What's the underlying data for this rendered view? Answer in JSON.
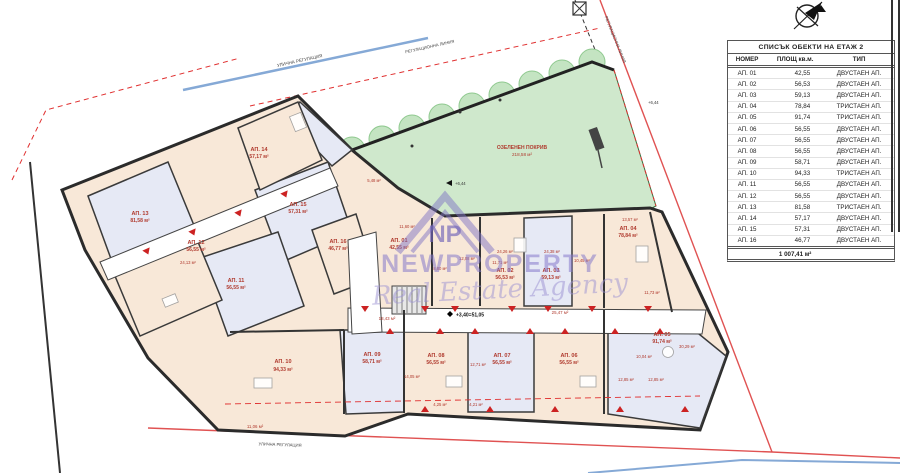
{
  "table": {
    "title": "СПИСЪК ОБЕКТИ НА ЕТАЖ 2",
    "col_number": "НОМЕР",
    "col_area": "ПЛОЩ кв.м.",
    "col_type": "ТИП",
    "total": "1 007,41 м²"
  },
  "apartments": [
    {
      "num": "АП. 01",
      "area": "42,55",
      "type": "ДВУСТАЕН АП."
    },
    {
      "num": "АП. 02",
      "area": "56,53",
      "type": "ДВУСТАЕН АП."
    },
    {
      "num": "АП. 03",
      "area": "59,13",
      "type": "ДВУСТАЕН АП."
    },
    {
      "num": "АП. 04",
      "area": "78,84",
      "type": "ТРИСТАЕН АП."
    },
    {
      "num": "АП. 05",
      "area": "91,74",
      "type": "ТРИСТАЕН АП."
    },
    {
      "num": "АП. 06",
      "area": "56,55",
      "type": "ДВУСТАЕН АП."
    },
    {
      "num": "АП. 07",
      "area": "56,55",
      "type": "ДВУСТАЕН АП."
    },
    {
      "num": "АП. 08",
      "area": "56,55",
      "type": "ДВУСТАЕН АП."
    },
    {
      "num": "АП. 09",
      "area": "58,71",
      "type": "ДВУСТАЕН АП."
    },
    {
      "num": "АП. 10",
      "area": "94,33",
      "type": "ТРИСТАЕН АП."
    },
    {
      "num": "АП. 11",
      "area": "56,55",
      "type": "ДВУСТАЕН АП."
    },
    {
      "num": "АП. 12",
      "area": "56,55",
      "type": "ДВУСТАЕН АП."
    },
    {
      "num": "АП. 13",
      "area": "81,58",
      "type": "ТРИСТАЕН АП."
    },
    {
      "num": "АП. 14",
      "area": "57,17",
      "type": "ДВУСТАЕН АП."
    },
    {
      "num": "АП. 15",
      "area": "57,31",
      "type": "ДВУСТАЕН АП."
    },
    {
      "num": "АП. 16",
      "area": "46,77",
      "type": "ДВУСТАЕН АП."
    }
  ],
  "plan": {
    "green_roof_label": "ОЗЕЛЕНЕН ПОКРИВ",
    "green_roof_area": "218,58 м²",
    "level_mark": "+3,40=51,05",
    "roof_mark": "+6,44",
    "corridor_area_1": "18,43 м²",
    "corridor_area_2": "25,47 м²",
    "terrace_area": "11,06 м²",
    "street_label": "УЛИЧНА РЕГУЛАЦИЯ",
    "boundary_label": "РЕГУЛАЦИОННА ЛИНИЯ",
    "units": [
      {
        "num": "АП. 01",
        "area": "42,55 м²"
      },
      {
        "num": "АП. 02",
        "area": "56,53 м²"
      },
      {
        "num": "АП. 03",
        "area": "59,13 м²"
      },
      {
        "num": "АП. 04",
        "area": "78,84 м²"
      },
      {
        "num": "АП. 05",
        "area": "91,74 м²"
      },
      {
        "num": "АП. 06",
        "area": "56,55 м²"
      },
      {
        "num": "АП. 07",
        "area": "56,55 м²"
      },
      {
        "num": "АП. 08",
        "area": "56,55 м²"
      },
      {
        "num": "АП. 09",
        "area": "58,71 м²"
      },
      {
        "num": "АП. 10",
        "area": "94,33 м²"
      },
      {
        "num": "АП. 11",
        "area": "56,55 м²"
      },
      {
        "num": "АП. 12",
        "area": "56,55 м²"
      },
      {
        "num": "АП. 13",
        "area": "81,58 м²"
      },
      {
        "num": "АП. 14",
        "area": "57,17 м²"
      },
      {
        "num": "АП. 15",
        "area": "57,31 м²"
      },
      {
        "num": "АП. 16",
        "area": "46,77 м²"
      }
    ],
    "room_labels": [
      "5,48 м²",
      "11,60 м²",
      "12,08 м²",
      "8,80 м²",
      "11,71 м²",
      "24,26 м²",
      "24,38 м²",
      "10,45 м²",
      "13,57 м²",
      "11,73 м²",
      "30,29 м²",
      "10,04 м²",
      "12,85 м²",
      "12,85 м²",
      "24,13 м²",
      "4,25 м²",
      "4,21 м²",
      "14,05 м²",
      "12,71 м²"
    ]
  },
  "watermark": {
    "logo": "NP",
    "brand": "NEWPROPERTY",
    "script": "Real Estate Agency"
  },
  "colors": {
    "unit_beige": "#f8e8d8",
    "unit_lavender": "#e6e9f5",
    "green_roof": "#cfe8cc",
    "label_red": "#b03a2e",
    "street_blue": "#85a9d6",
    "boundary_red": "#e03030"
  }
}
